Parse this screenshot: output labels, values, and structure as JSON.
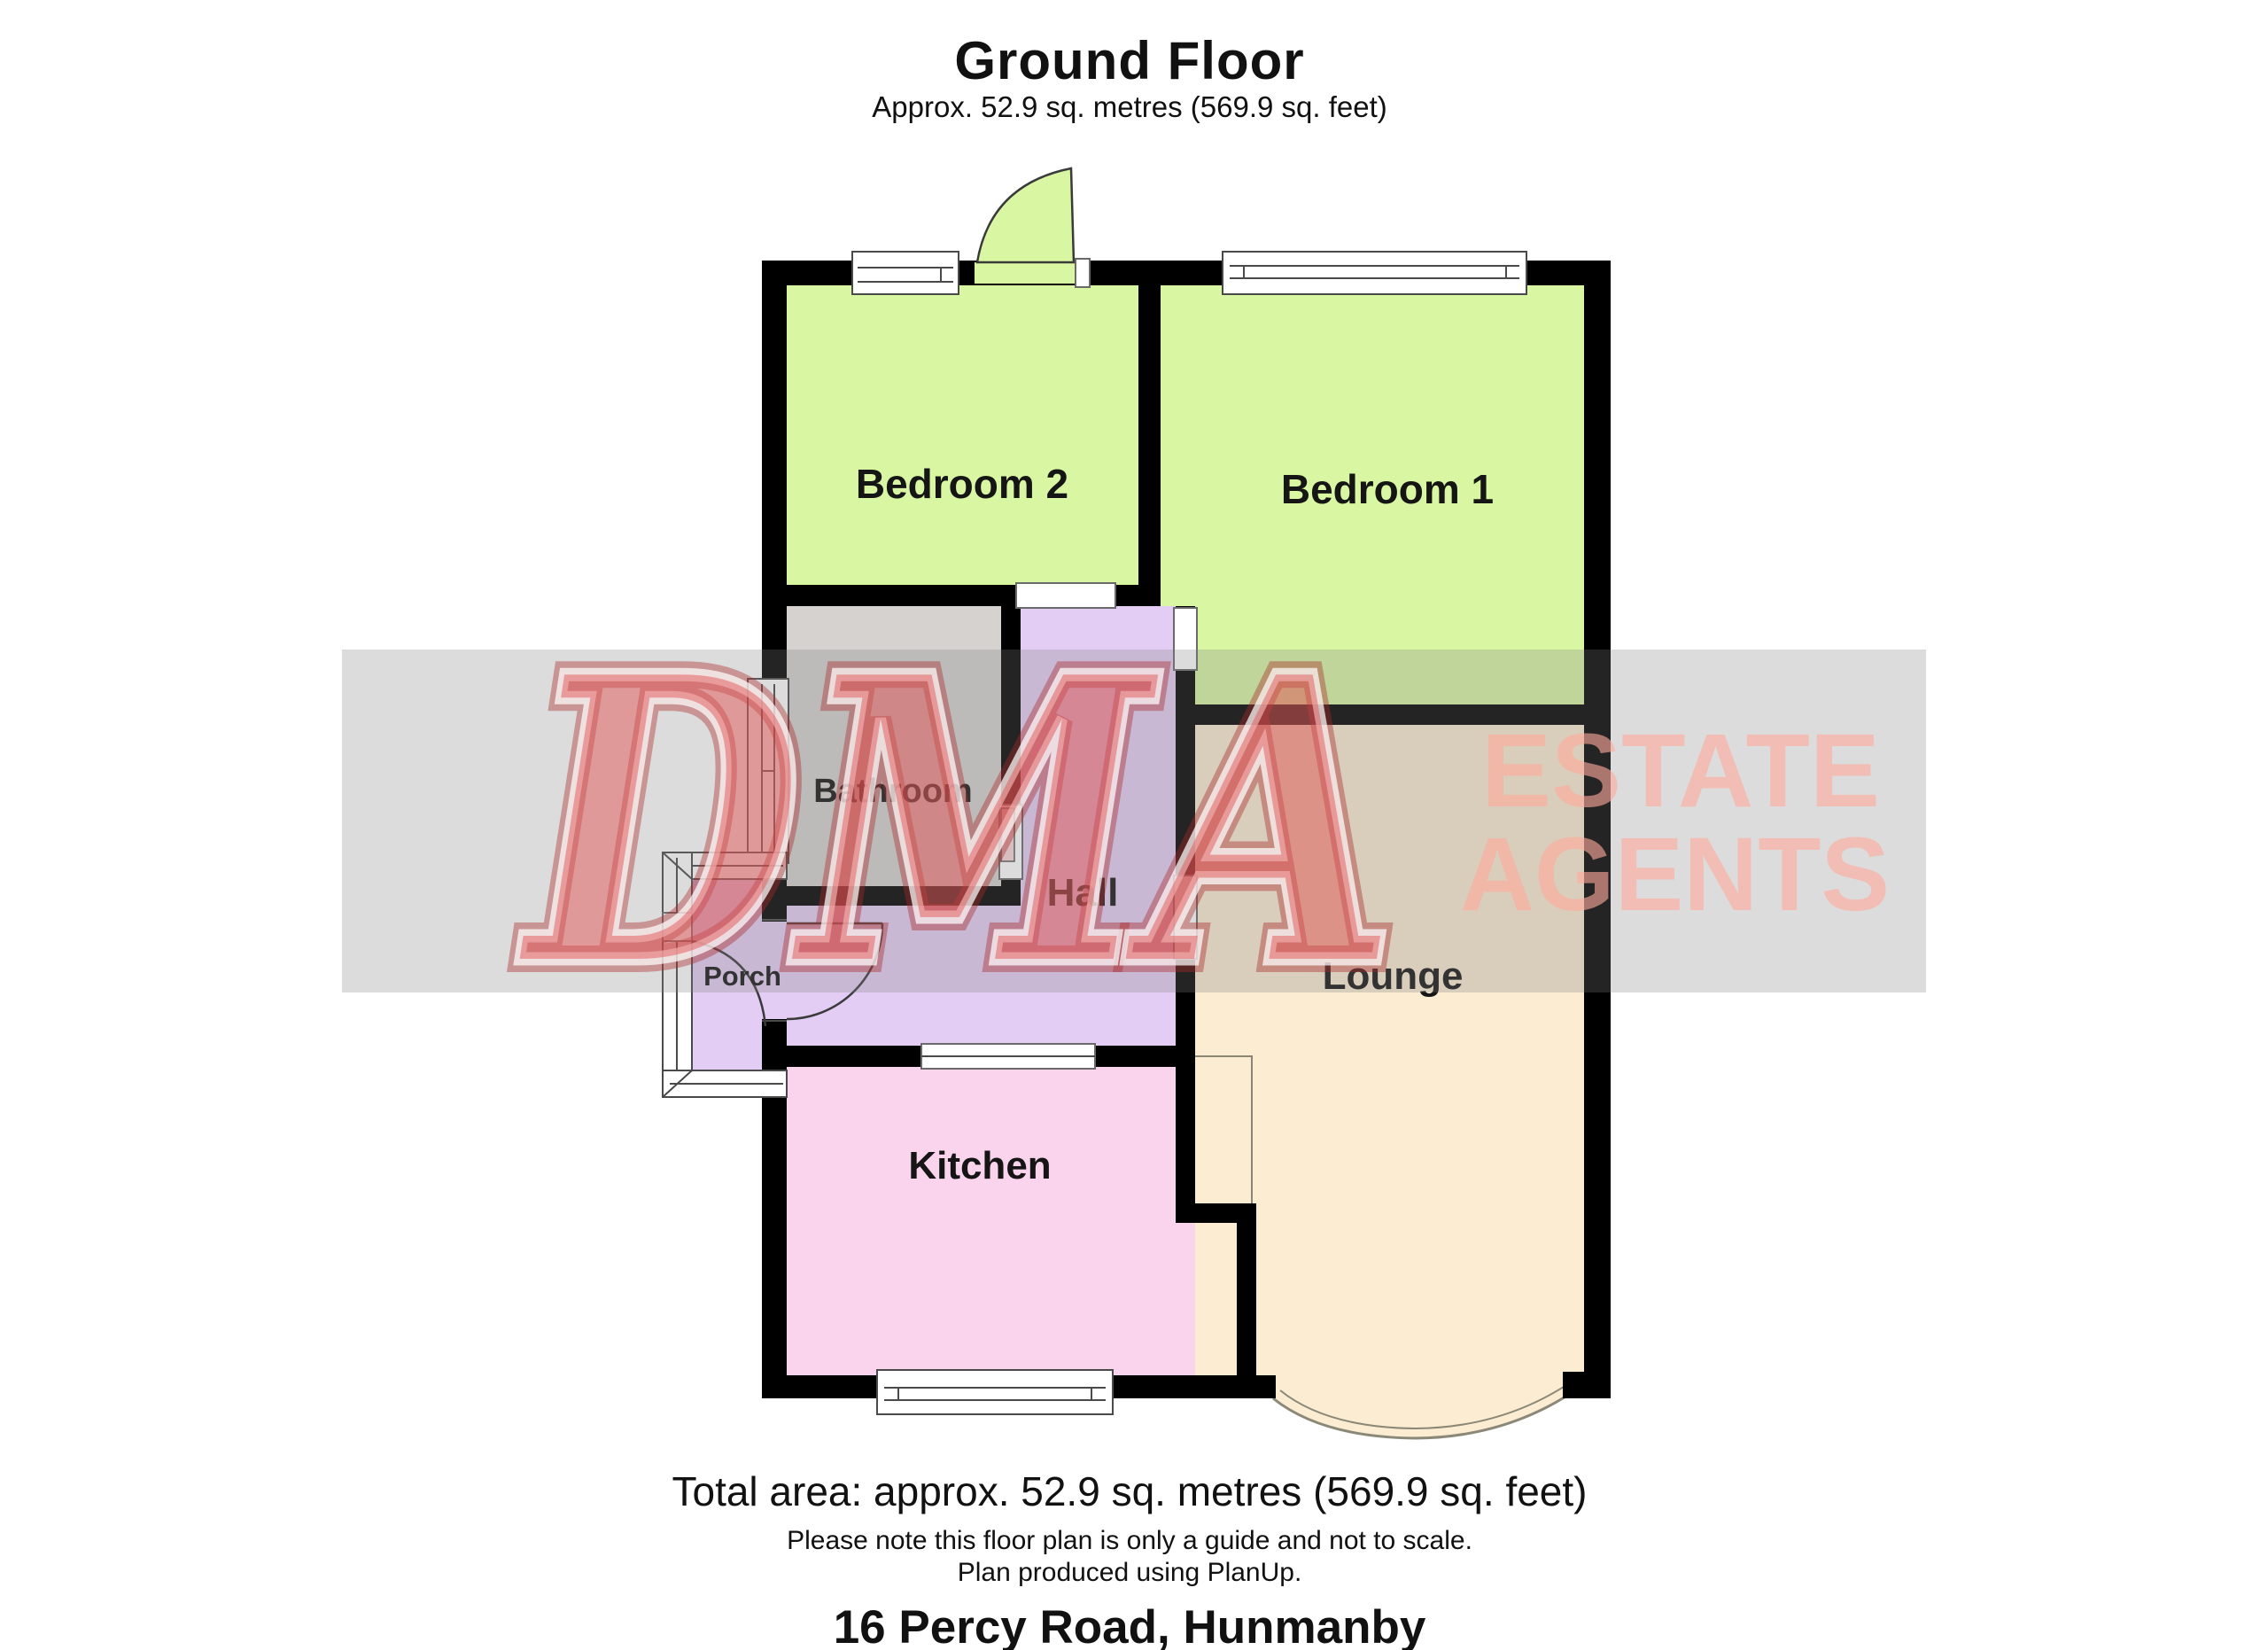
{
  "header": {
    "title": "Ground Floor",
    "subtitle": "Approx. 52.9 sq. metres (569.9 sq. feet)"
  },
  "rooms": {
    "bedroom2": {
      "label": "Bedroom 2",
      "color": "#d9f6a3"
    },
    "bedroom1": {
      "label": "Bedroom 1",
      "color": "#d9f6a3"
    },
    "bathroom": {
      "label": "Bathroom",
      "color": "#d5d2cf"
    },
    "hall": {
      "label": "Hall",
      "color": "#e3cdf4"
    },
    "porch": {
      "label": "Porch",
      "color": "#e3cdf4"
    },
    "lounge": {
      "label": "Lounge",
      "color": "#fbecd2"
    },
    "kitchen": {
      "label": "Kitchen",
      "color": "#fad4ec"
    }
  },
  "watermark": {
    "word": "DMA",
    "line1": "ESTATE",
    "line2": "AGENTS",
    "brand_red": "#e05555",
    "light_red": "#ffb9ac",
    "band_gray": "#e2e2e2"
  },
  "footer": {
    "total_area": "Total area: approx. 52.9 sq. metres (569.9 sq. feet)",
    "note": "Please note this floor plan is only a guide and not to scale.",
    "produced": "Plan produced using PlanUp.",
    "address": "16 Percy Road, Hunmanby"
  },
  "plan": {
    "wall_color": "#000000"
  }
}
